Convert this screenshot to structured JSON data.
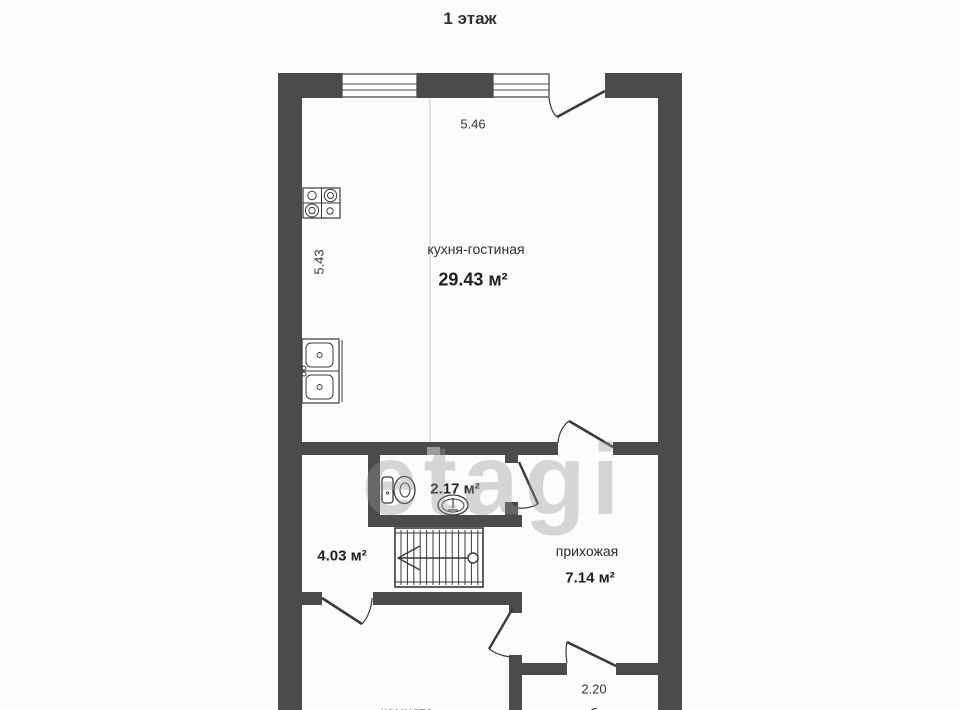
{
  "title": "1 этаж",
  "watermark": "etagi",
  "dimensions": {
    "kitchen_width": "5.46",
    "kitchen_depth": "5.43",
    "tambour_width": "2.20"
  },
  "rooms": {
    "kitchen": {
      "name": "кухня-гостиная",
      "area": "29.43 м²"
    },
    "toilet": {
      "area": "2.17 м²"
    },
    "stair_hall": {
      "area": "4.03 м²"
    },
    "hallway": {
      "name": "прихожая",
      "area": "7.14 м²"
    },
    "bedroom": {
      "name": "комната"
    },
    "tambour": {
      "name": "тамбур"
    }
  },
  "icons": {
    "window-icon": "double-frame window in wall",
    "door-swing-icon": "door leaf with swing arc",
    "stove-icon": "4-burner cooktop",
    "kitchen-sink-icon": "double-bowl kitchen sink",
    "toilet-icon": "toilet with tank",
    "washbasin-icon": "pedestal washbasin",
    "stairs-icon": "staircase with up arrow"
  },
  "colors": {
    "wall": "#4b4b4d",
    "outline": "#3a3a3c",
    "zone_divider": "#d9d9d9",
    "dimension_tick": "#9b9b9b",
    "watermark": "#bdbdbd",
    "background": "#fcfcfc"
  }
}
